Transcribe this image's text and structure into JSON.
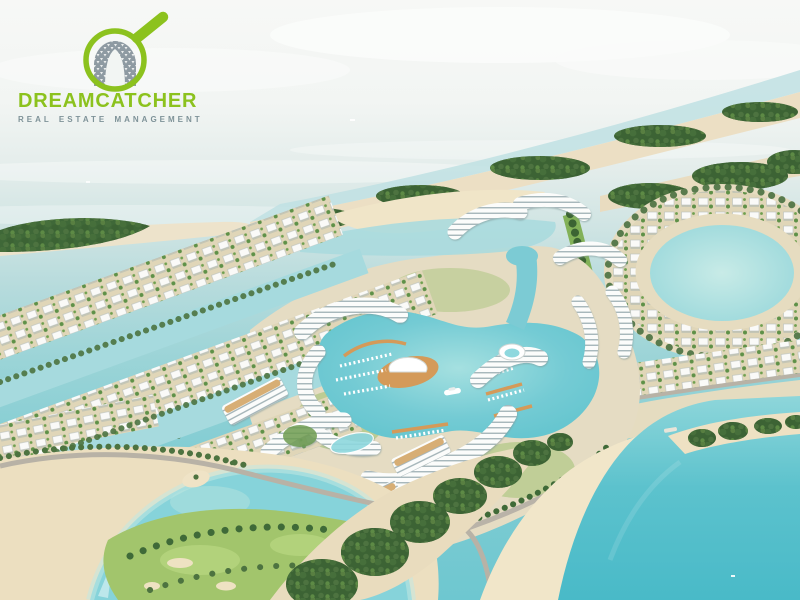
{
  "brand": {
    "name": "DREAMCATCHER",
    "tagline": "REAL ESTATE MANAGEMENT",
    "name_color": "#8cc21e",
    "tagline_color": "#7e9298",
    "icon": "magnifying-glass-over-ornamental-arch"
  },
  "scene": {
    "alt": "Aerial 3D rendering of a coastal master-planned island community: rows of white villas along turquoise canals, a central marina lagoon with docked boats, a yacht and a shell-roofed pavilion on a wooden deck, curved white mid-rise apartment buildings, a villa-ringed lagoon on the right, sandbars with dense mangroves, beaches, a landscaped park with a road and roundabout, and a large turquoise bay at lower right",
    "colors": {
      "sky_haze": "#f7f8f6",
      "far_sea": "#cfe4e3",
      "canal": "#a6dade",
      "marina_lagoon": "#6ec7d0",
      "bay": "#49bac8",
      "sand": "#ecdfc2",
      "mangrove_green": "#3c6334",
      "lawn_green": "#a2c56c",
      "building_white": "#fbfcfb",
      "deck_wood": "#d49a59"
    }
  }
}
